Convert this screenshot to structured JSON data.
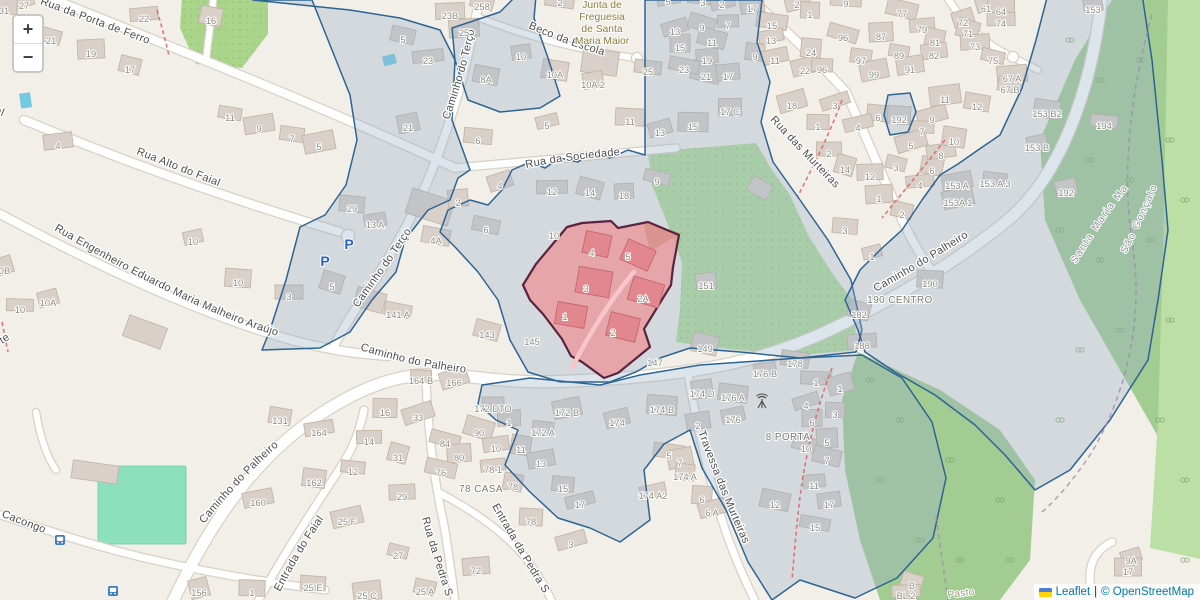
{
  "controls": {
    "zoom_in": "+",
    "zoom_out": "−"
  },
  "attribution": {
    "flag_icon": "ukraine-flag",
    "leaflet_link": "Leaflet",
    "separator": "|",
    "osm_text": "© OpenStreetMap"
  },
  "colors": {
    "land": "#f2efe9",
    "building": "#d9d0c9",
    "building_outline": "#c2b5a6",
    "road": "#ffffff",
    "road_casing": "#d9d2c5",
    "green_orchard": "#b4dd9b",
    "green_patch": "#abd48b",
    "forest": "#a3cc93",
    "forest_light": "#bbdfa5",
    "pitch": "#8ce0bd",
    "water": "#73cbe2",
    "overlay_fill": "rgba(150,172,198,0.33)",
    "overlay_stroke": "#2e6492",
    "parcel_fill": "rgba(238,138,142,0.66)",
    "parcel_stroke": "#5a2340",
    "parcel_building": "#e2878d",
    "street_label": "#4d4d4d",
    "house_number": "#8b8b82",
    "poi_label": "#8d7c3c",
    "boundary_label": "#8f8f9c",
    "meadow_label": "#8f9a73",
    "parking_icon": "#2a63c8",
    "footpath": "#e06060",
    "admin_boundary": "#a08ab0"
  },
  "map": {
    "street_labels": [
      {
        "id": "porta-ferro",
        "text": "Rua da Porta de Ferro"
      },
      {
        "id": "o-faial",
        "text": "o Faial"
      },
      {
        "id": "alto-faial",
        "text": "Rua Alto do Faial"
      },
      {
        "id": "engenheiro",
        "text": "Rua Engenheiro Eduardo Maria Malheiro Araújo"
      },
      {
        "id": "terco-upper",
        "text": "Caminho do Terço"
      },
      {
        "id": "terco-lower",
        "text": "Caminho do Terço"
      },
      {
        "id": "sociedade",
        "text": "Rua da Sociedade"
      },
      {
        "id": "beco-escola",
        "text": "Beco da Escola"
      },
      {
        "id": "murteiras",
        "text": "Rua das Murteiras"
      },
      {
        "id": "travessa-murteiras",
        "text": "Travessa das Murteiras"
      },
      {
        "id": "palheiro-west",
        "text": "Caminho do Palheiro"
      },
      {
        "id": "palheiro-sw",
        "text": "Caminho do Palheiro"
      },
      {
        "id": "palheiro-east",
        "text": "Caminho do Palheiro"
      },
      {
        "id": "entrada-faial",
        "text": "Entrada do Faial"
      },
      {
        "id": "pedra-s",
        "text": "Rua da Pedra S"
      },
      {
        "id": "entrada-pedra",
        "text": "Entrada da Pedra S"
      },
      {
        "id": "cacongo",
        "text": "Visconde Cacongo"
      },
      {
        "id": "te",
        "text": "te"
      },
      {
        "id": "santa-maria",
        "text": "Santa Maria Maior",
        "cls": "boundary"
      },
      {
        "id": "sao-goncalo",
        "text": "São Gonçalo",
        "cls": "boundary"
      },
      {
        "id": "pasto",
        "text": "Pasto",
        "cls": "meadow"
      }
    ],
    "poi_junta": {
      "lines": [
        "Junta de",
        "Freguesia",
        "de Santa",
        "Maria Maior"
      ],
      "x": 602,
      "y0": 8,
      "dy": 12
    },
    "place_labels": [
      {
        "text": "190 CENTRO",
        "x": 900,
        "y": 303
      },
      {
        "text": "8 PORTA",
        "x": 788,
        "y": 440
      },
      {
        "text": "78 CASA",
        "x": 481,
        "y": 492
      }
    ],
    "house_numbers": [
      [
        "27",
        24,
        6
      ],
      [
        "31",
        4,
        11
      ],
      [
        "21",
        51,
        41
      ],
      [
        "19",
        91,
        54
      ],
      [
        "17",
        130,
        70
      ],
      [
        "22",
        144,
        19
      ],
      [
        "16",
        211,
        21
      ],
      [
        "4",
        58,
        146
      ],
      [
        "11",
        230,
        118
      ],
      [
        "9",
        259,
        129
      ],
      [
        "7",
        292,
        139
      ],
      [
        "5",
        319,
        147
      ],
      [
        "29",
        352,
        209
      ],
      [
        "10",
        193,
        242
      ],
      [
        "10",
        238,
        283
      ],
      [
        "10A",
        48,
        303
      ],
      [
        "10",
        20,
        310
      ],
      [
        "10B",
        2,
        271
      ],
      [
        "3",
        289,
        297
      ],
      [
        "5",
        332,
        287
      ],
      [
        "23B",
        450,
        16
      ],
      [
        "258",
        482,
        7
      ],
      [
        "25",
        464,
        33
      ],
      [
        "5",
        403,
        40
      ],
      [
        "23",
        428,
        61
      ],
      [
        "8A",
        486,
        80
      ],
      [
        "10",
        521,
        57
      ],
      [
        "10A",
        555,
        75
      ],
      [
        "10A 2",
        593,
        85
      ],
      [
        "25",
        648,
        72
      ],
      [
        "21",
        408,
        128
      ],
      [
        "6",
        478,
        141
      ],
      [
        "5",
        547,
        126
      ],
      [
        "11",
        630,
        122
      ],
      [
        "13",
        660,
        133
      ],
      [
        "15",
        693,
        127
      ],
      [
        "4",
        500,
        186
      ],
      [
        "12",
        552,
        192
      ],
      [
        "14",
        590,
        193
      ],
      [
        "18",
        624,
        196
      ],
      [
        "9",
        657,
        182
      ],
      [
        "2",
        458,
        203
      ],
      [
        "6",
        486,
        230
      ],
      [
        "10",
        554,
        236
      ],
      [
        "4A",
        436,
        241
      ],
      [
        "13 A",
        375,
        225
      ],
      [
        "2",
        560,
        3
      ],
      [
        "5",
        668,
        2
      ],
      [
        "3",
        703,
        3
      ],
      [
        "2",
        722,
        5
      ],
      [
        "9",
        846,
        4
      ],
      [
        "2",
        797,
        5
      ],
      [
        "1",
        810,
        15
      ],
      [
        "13",
        675,
        32
      ],
      [
        "15",
        680,
        48
      ],
      [
        "9",
        702,
        28
      ],
      [
        "7",
        728,
        26
      ],
      [
        "11",
        712,
        43
      ],
      [
        "19",
        707,
        61
      ],
      [
        "21",
        706,
        77
      ],
      [
        "17",
        728,
        77
      ],
      [
        "23",
        684,
        70
      ],
      [
        "17",
        752,
        9
      ],
      [
        "15",
        772,
        26
      ],
      [
        "13",
        771,
        41
      ],
      [
        "9",
        755,
        57
      ],
      [
        "11",
        775,
        61
      ],
      [
        "24",
        811,
        53
      ],
      [
        "22",
        805,
        71
      ],
      [
        "96",
        822,
        70
      ],
      [
        "18",
        792,
        106
      ],
      [
        "1",
        818,
        127
      ],
      [
        "3",
        835,
        106
      ],
      [
        "17 C",
        730,
        112
      ],
      [
        "96",
        843,
        38
      ],
      [
        "87",
        881,
        37
      ],
      [
        "77",
        902,
        14
      ],
      [
        "79",
        922,
        30
      ],
      [
        "81",
        935,
        43
      ],
      [
        "82",
        934,
        56
      ],
      [
        "89",
        899,
        56
      ],
      [
        "91",
        910,
        70
      ],
      [
        "97",
        861,
        61
      ],
      [
        "99",
        874,
        75
      ],
      [
        "6",
        878,
        118
      ],
      [
        "4",
        858,
        128
      ],
      [
        "192",
        899,
        120
      ],
      [
        "9",
        932,
        120
      ],
      [
        "7",
        922,
        132
      ],
      [
        "5",
        911,
        146
      ],
      [
        "2",
        829,
        154
      ],
      [
        "14",
        845,
        170
      ],
      [
        "12",
        870,
        177
      ],
      [
        "3",
        896,
        168
      ],
      [
        "1",
        879,
        199
      ],
      [
        "2",
        902,
        215
      ],
      [
        "4",
        920,
        186
      ],
      [
        "6",
        932,
        171
      ],
      [
        "8",
        941,
        156
      ],
      [
        "10",
        954,
        142
      ],
      [
        "153 A",
        957,
        186
      ],
      [
        "153 A 3",
        995,
        184
      ],
      [
        "153A 1",
        958,
        203
      ],
      [
        "3",
        845,
        231
      ],
      [
        "1",
        872,
        257
      ],
      [
        "190",
        930,
        284
      ],
      [
        "61",
        986,
        9
      ],
      [
        "64",
        1001,
        12
      ],
      [
        "72",
        963,
        23
      ],
      [
        "74",
        1001,
        24
      ],
      [
        "71",
        968,
        34
      ],
      [
        "73",
        975,
        47
      ],
      [
        "75",
        993,
        61
      ],
      [
        "67 A",
        1012,
        79
      ],
      [
        "67 B",
        1010,
        90
      ],
      [
        "11",
        945,
        100
      ],
      [
        "12",
        977,
        107
      ],
      [
        "153",
        1093,
        10
      ],
      [
        "153 B2",
        1047,
        114
      ],
      [
        "153 B",
        1037,
        148
      ],
      [
        "194",
        1104,
        126
      ],
      [
        "192",
        1066,
        193
      ],
      [
        "4",
        592,
        253
      ],
      [
        "5",
        628,
        257
      ],
      [
        "3",
        586,
        289
      ],
      [
        "2A",
        643,
        299
      ],
      [
        "1",
        565,
        317
      ],
      [
        "2",
        613,
        333
      ],
      [
        "145",
        532,
        342
      ],
      [
        "143",
        487,
        335
      ],
      [
        "147",
        655,
        363
      ],
      [
        "149",
        705,
        349
      ],
      [
        "151",
        706,
        286
      ],
      [
        "141 A",
        398,
        315
      ],
      [
        "174 D",
        702,
        394
      ],
      [
        "178",
        795,
        364
      ],
      [
        "176 B",
        765,
        374
      ],
      [
        "176 A",
        733,
        398
      ],
      [
        "176",
        733,
        420
      ],
      [
        "174 B",
        662,
        410
      ],
      [
        "174",
        617,
        423
      ],
      [
        "1",
        816,
        383
      ],
      [
        "1",
        840,
        389
      ],
      [
        "3",
        835,
        415
      ],
      [
        "4",
        806,
        406
      ],
      [
        "6",
        812,
        423
      ],
      [
        "10",
        806,
        449
      ],
      [
        "5",
        827,
        443
      ],
      [
        "7",
        827,
        461
      ],
      [
        "11",
        814,
        486
      ],
      [
        "12",
        775,
        505
      ],
      [
        "17",
        829,
        505
      ],
      [
        "15",
        815,
        528
      ],
      [
        "2",
        698,
        426
      ],
      [
        "5",
        669,
        456
      ],
      [
        "7",
        680,
        463
      ],
      [
        "174 A",
        685,
        477
      ],
      [
        "174 A2",
        653,
        496
      ],
      [
        "6",
        702,
        500
      ],
      [
        "6 A",
        712,
        513
      ],
      [
        "164 B",
        421,
        381
      ],
      [
        "166",
        454,
        383
      ],
      [
        "172 DTO",
        493,
        409
      ],
      [
        "90",
        479,
        433
      ],
      [
        "1",
        509,
        423
      ],
      [
        "84",
        445,
        444
      ],
      [
        "80",
        459,
        458
      ],
      [
        "76",
        441,
        473
      ],
      [
        "78 1",
        493,
        470
      ],
      [
        "78",
        513,
        487
      ],
      [
        "10",
        496,
        449
      ],
      [
        "11",
        521,
        450
      ],
      [
        "13",
        541,
        464
      ],
      [
        "172 A",
        543,
        433
      ],
      [
        "172 B",
        567,
        413
      ],
      [
        "15",
        563,
        489
      ],
      [
        "17",
        580,
        505
      ],
      [
        "78",
        531,
        522
      ],
      [
        "3",
        571,
        545
      ],
      [
        "16",
        385,
        413
      ],
      [
        "33",
        418,
        418
      ],
      [
        "14",
        369,
        442
      ],
      [
        "31",
        398,
        458
      ],
      [
        "29",
        402,
        497
      ],
      [
        "27",
        398,
        556
      ],
      [
        "72",
        476,
        571
      ],
      [
        "25 A",
        425,
        592
      ],
      [
        "25 C",
        367,
        596
      ],
      [
        "131",
        280,
        421
      ],
      [
        "164",
        319,
        433
      ],
      [
        "162",
        314,
        483
      ],
      [
        "160",
        258,
        503
      ],
      [
        "12",
        353,
        472
      ],
      [
        "25 F",
        347,
        522
      ],
      [
        "25 E",
        313,
        588
      ],
      [
        "156",
        199,
        593
      ],
      [
        "1",
        252,
        593
      ],
      [
        "9A",
        1131,
        561
      ],
      [
        "17",
        1128,
        572
      ],
      [
        "B",
        912,
        586
      ],
      [
        "BL 2",
        906,
        596
      ],
      [
        "182",
        859,
        315
      ],
      [
        "188",
        862,
        346
      ]
    ],
    "icons": [
      {
        "name": "parking-icon",
        "glyph": "P",
        "x": 325,
        "y": 266
      },
      {
        "name": "parking-icon",
        "glyph": "P",
        "x": 349,
        "y": 249
      },
      {
        "name": "bus-stop-icon",
        "x": 60,
        "y": 540
      },
      {
        "name": "bus-stop-icon",
        "x": 113,
        "y": 591
      },
      {
        "name": "antenna-icon",
        "x": 762,
        "y": 404
      }
    ]
  }
}
